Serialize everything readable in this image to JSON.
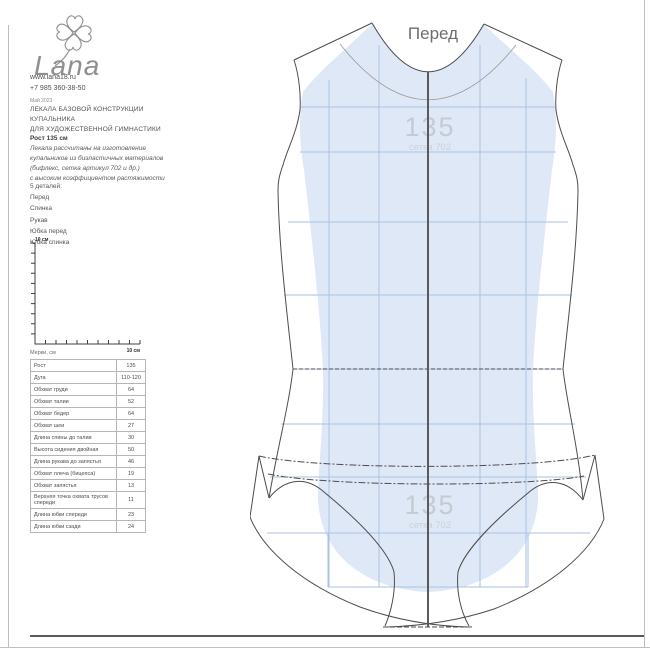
{
  "brand": {
    "logo_text": "Lana",
    "website": "www.lana18.ru",
    "phone": "+7 985 360-38-50"
  },
  "header": {
    "date": "Май 2023",
    "title_lines": [
      "ЛЕКАЛА БАЗОВОЙ КОНСТРУКЦИИ",
      "КУПАЛЬНИКА",
      "ДЛЯ ХУДОЖЕСТВЕННОЙ ГИМНАСТИКИ"
    ],
    "height": "Рост 135 см",
    "description_lines": [
      "Лекала рассчитаны на изготовление",
      "купальников из биэластичных материалов",
      "(бифлекс, сетка артикул 702 и др.)",
      "с высоким коэффициентом растяжимости"
    ]
  },
  "details": {
    "heading": "5 деталей:",
    "items": [
      "Перед",
      "Спинка",
      "Рукав",
      "Юбка перед",
      "Юбка спинка"
    ]
  },
  "ruler": {
    "v_label": "10 см",
    "h_label": "10 см"
  },
  "measurements": {
    "heading": "Мерки, см",
    "rows": [
      [
        "Рост",
        "135"
      ],
      [
        "Дуга",
        "110-120"
      ],
      [
        "Обхват груди",
        "64"
      ],
      [
        "Обхват талии",
        "52"
      ],
      [
        "Обхват бедер",
        "64"
      ],
      [
        "Обхват шеи",
        "27"
      ],
      [
        "Длина спины до талии",
        "30"
      ],
      [
        "Высота сидения двойная",
        "50"
      ],
      [
        "Длина рукава до запястья",
        "46"
      ],
      [
        "Обхват плеча (бицепса)",
        "19"
      ],
      [
        "Обхват запястья",
        "13"
      ],
      [
        "Верхняя точка охвата трусов спереди",
        "11"
      ],
      [
        "Длина юбки спереди",
        "23"
      ],
      [
        "Длина юбки сзади",
        "24"
      ]
    ]
  },
  "pattern": {
    "title": "Перед",
    "watermark_value": "135",
    "watermark_caption": "сетка 702"
  },
  "colors": {
    "mesh_fill": "#dfe8f6",
    "grid_line": "#a9c2e6",
    "outline": "#4d4d4d",
    "center_line": "#5a5a5a",
    "watermark_value": "#c5cad3",
    "watermark_caption": "#ccd1da",
    "title": "#6e6e6e"
  }
}
